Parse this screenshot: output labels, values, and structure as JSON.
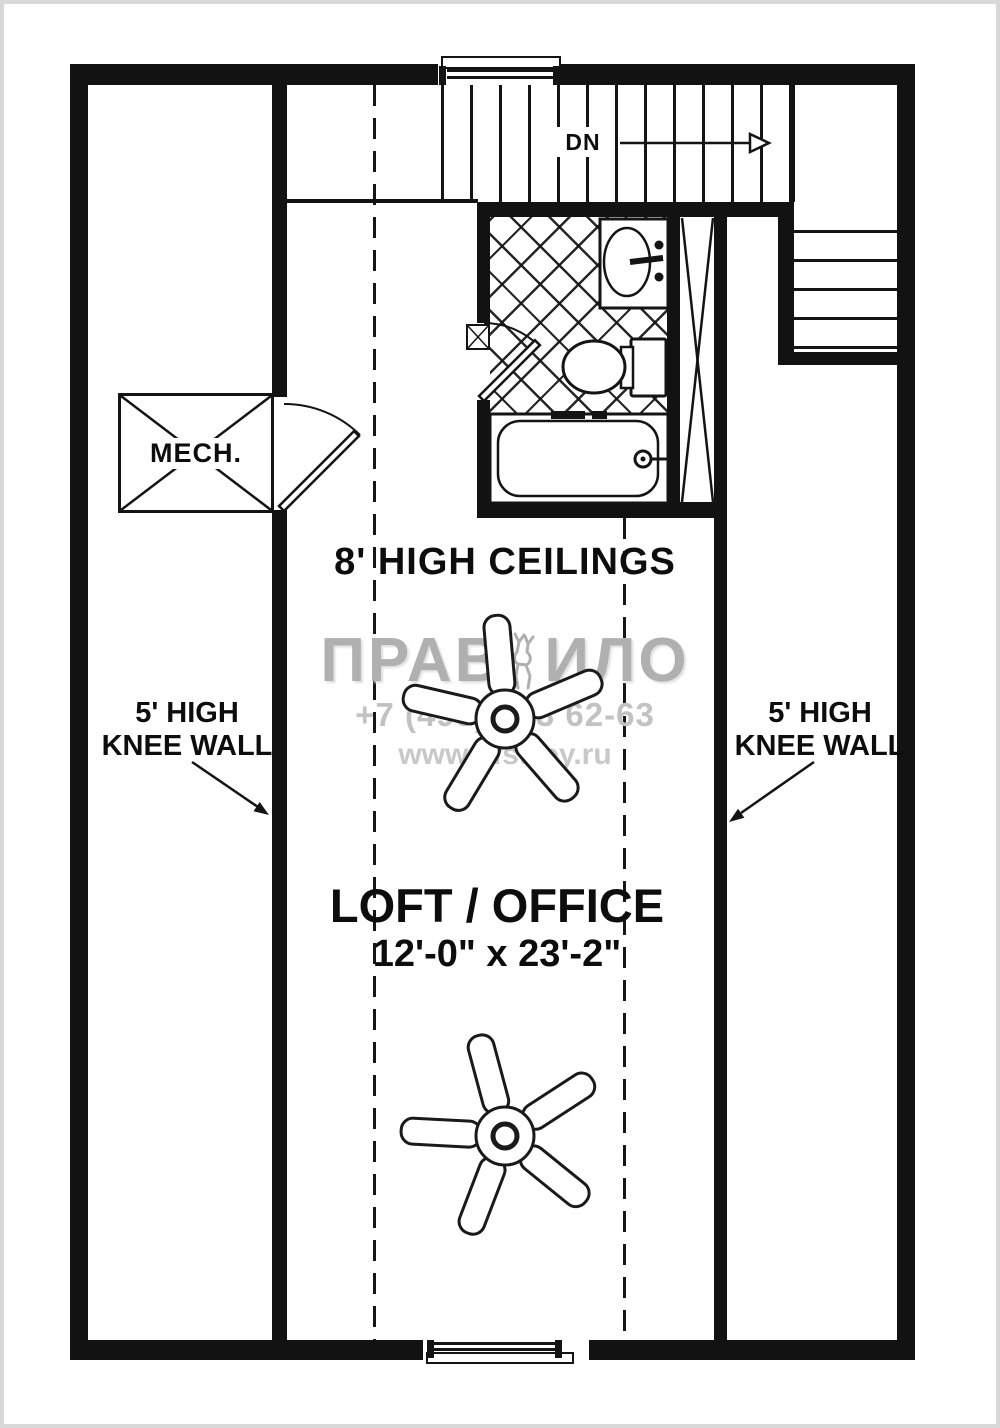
{
  "plan": {
    "stairs_label": "DN",
    "mech_label": "MECH.",
    "ceiling_note": "8' HIGH CEILINGS",
    "knee_wall_note_line1": "5' HIGH",
    "knee_wall_note_line2": "KNEE WALL",
    "room_name": "LOFT / OFFICE",
    "room_dimensions": "12'-0\" x 23'-2\""
  },
  "watermark": {
    "brand_left": "ПРАВ",
    "brand_right": "ИЛО",
    "phone": "+7 (495) 363 62-63",
    "website": "www.vfstroy.ru"
  },
  "colors": {
    "wall": "#121212",
    "background": "#ffffff",
    "watermark_gray": "#b0b0b0"
  }
}
